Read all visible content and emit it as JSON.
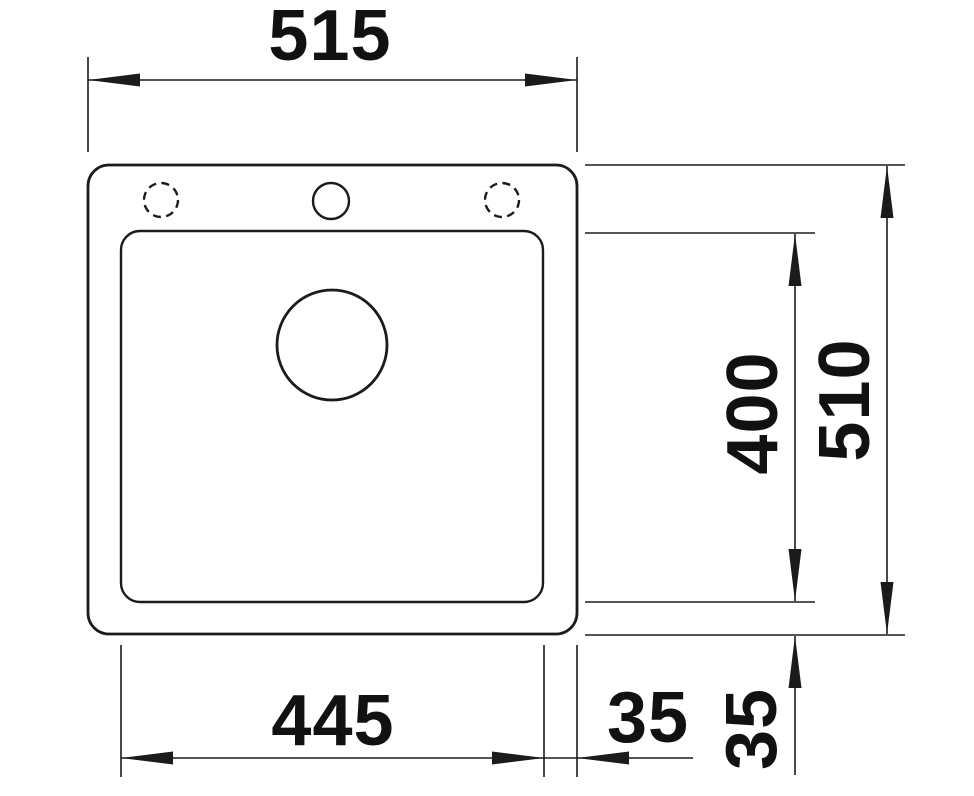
{
  "drawing": {
    "background": "#ffffff",
    "line_color": "#1b1b1b",
    "text_color": "#111111",
    "labels": {
      "overall_width": "515",
      "overall_depth": "510",
      "basin_depth": "400",
      "basin_width": "445",
      "offset_bottom_horizontal": "35",
      "offset_bottom_vertical": "35"
    }
  }
}
